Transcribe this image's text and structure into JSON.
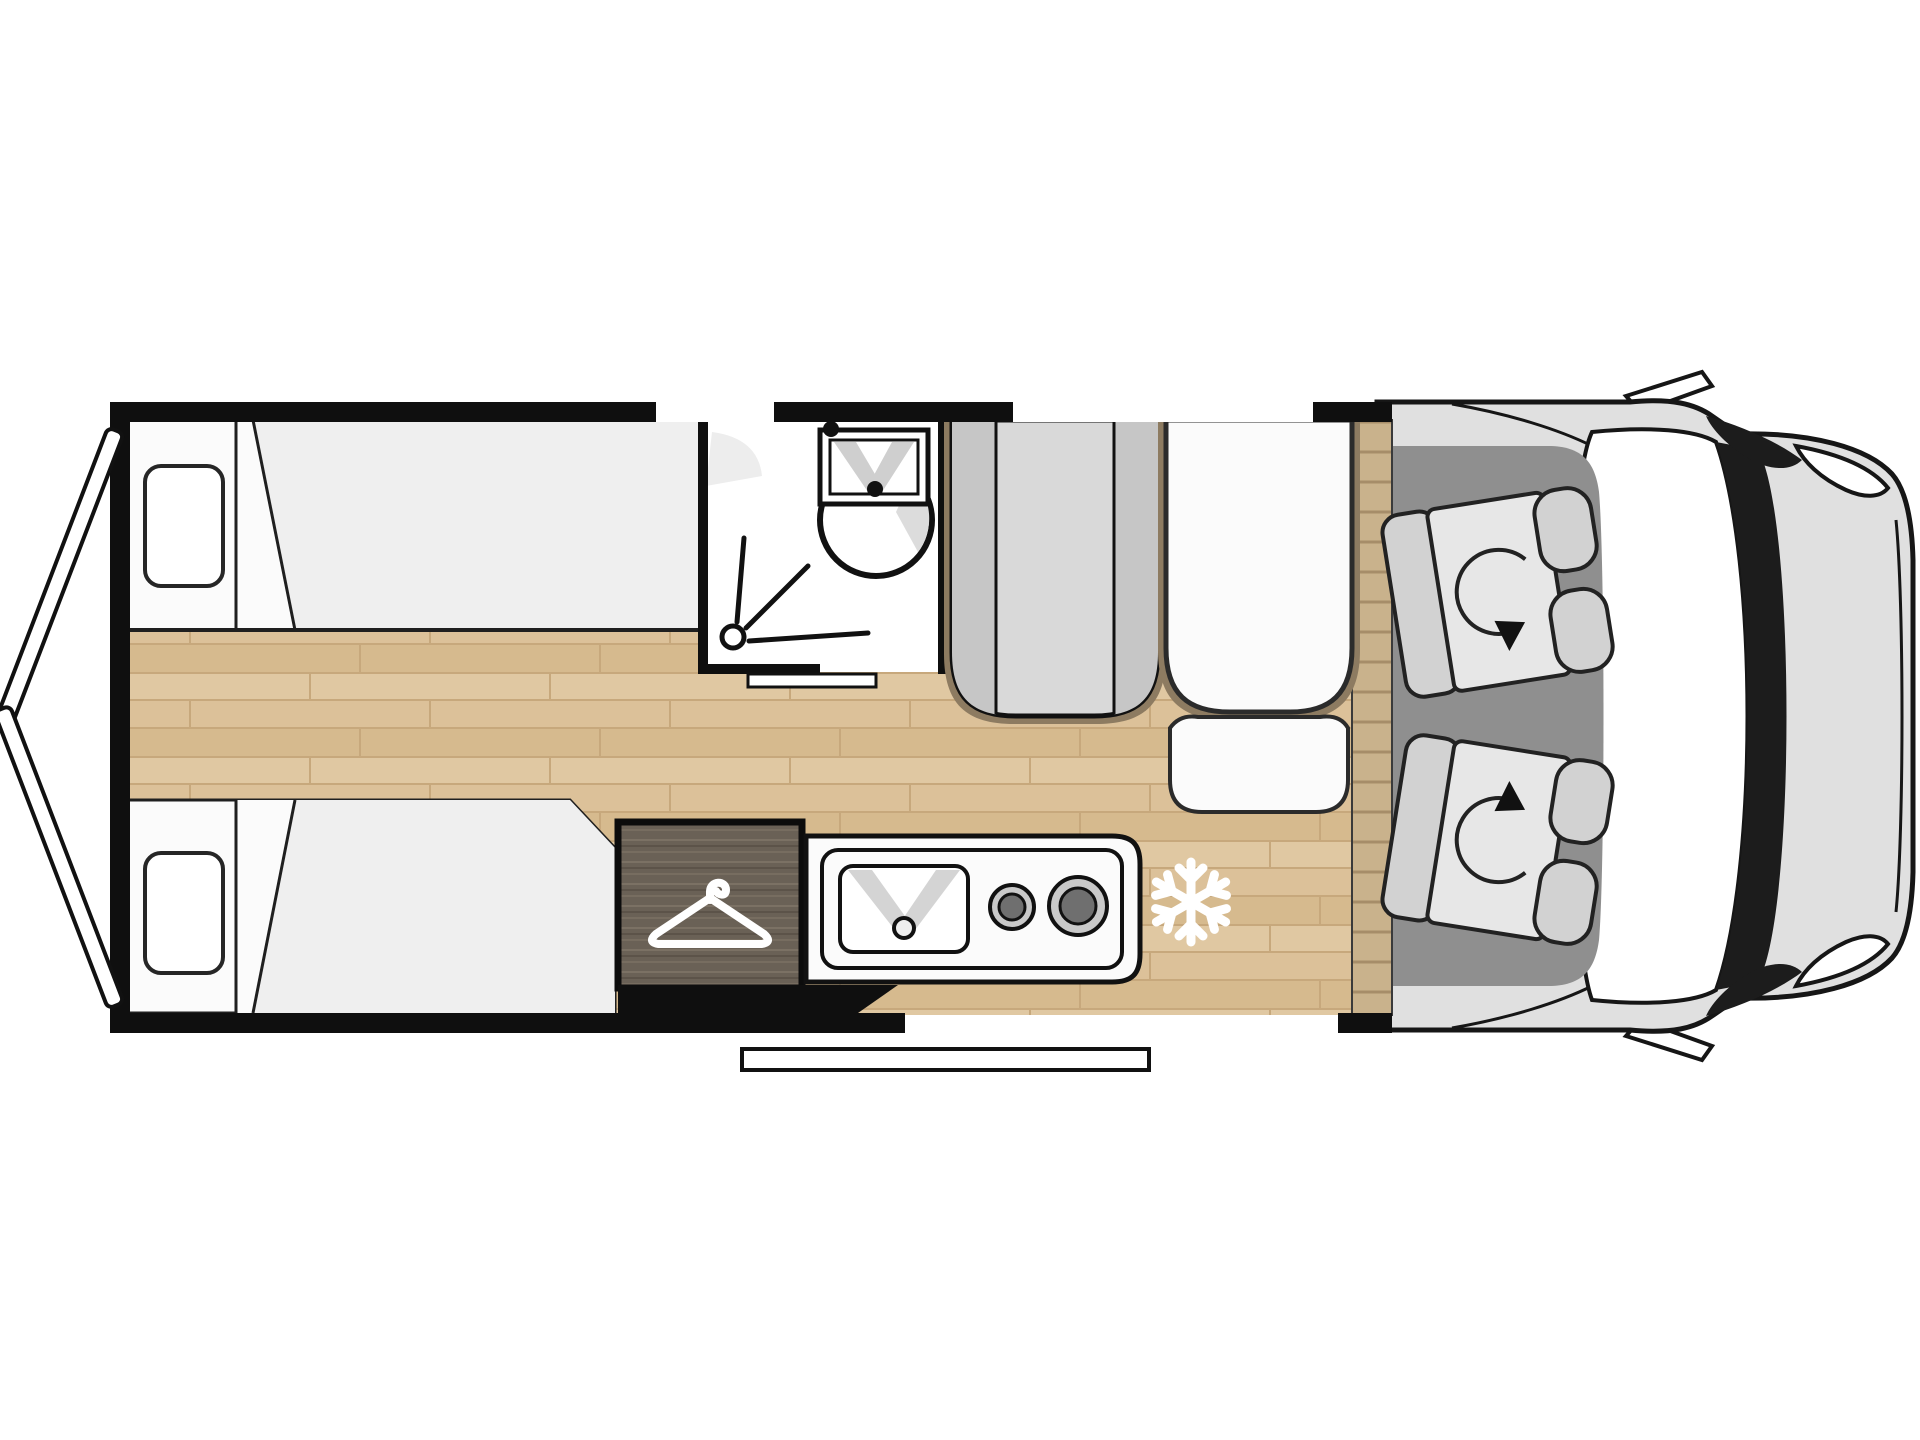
{
  "page": {
    "background": "#ffffff"
  },
  "floorplan": {
    "type": "campervan-top-view-floorplan",
    "colors": {
      "wall": "#0f0f0f",
      "outline": "#161616",
      "wood": "#dcc199",
      "woodline": "#c7a87c",
      "woodrow1": "#e0c8a2",
      "woodrow2": "#d6ba8e",
      "wardrobe": "#6a6156",
      "wardrobegrain": "#7b7164",
      "unit": "#d9d9d9",
      "unitside": "#c6c6c6",
      "cabfloor": "#8f8f8f",
      "body": "#e0e0e0",
      "windshield": "#1c1c1c",
      "seat": "#d2d2d2",
      "cushion": "#e7e7e7",
      "divider": "#c9b28c",
      "dividerline": "#a68d69",
      "white": "#fbfbfb",
      "mattress": "#efefef",
      "halo": "#8d7b61",
      "burner": "#c9c9c9",
      "burnerdark": "#6f6f6f",
      "shadow": "#d4d4d4"
    },
    "icons": [
      {
        "name": "hanger-icon",
        "meaning": "wardrobe"
      },
      {
        "name": "snowflake-icon",
        "meaning": "refrigerator position"
      },
      {
        "name": "swivel-arrow-icon",
        "meaning": "rotating cab seat"
      },
      {
        "name": "shower-drain-icon",
        "meaning": "shower tray"
      },
      {
        "name": "washbasin-icon",
        "meaning": "bathroom sink"
      },
      {
        "name": "kitchen-sink-icon",
        "meaning": "kitchen sink"
      },
      {
        "name": "burner-icon",
        "meaning": "gas hob"
      }
    ],
    "features": {
      "beds": 2,
      "pillows": 2,
      "cab_seats": 2,
      "hob_burners": 2,
      "rear_doors": 2,
      "wall_windows": 2,
      "entry_step": 1
    }
  }
}
